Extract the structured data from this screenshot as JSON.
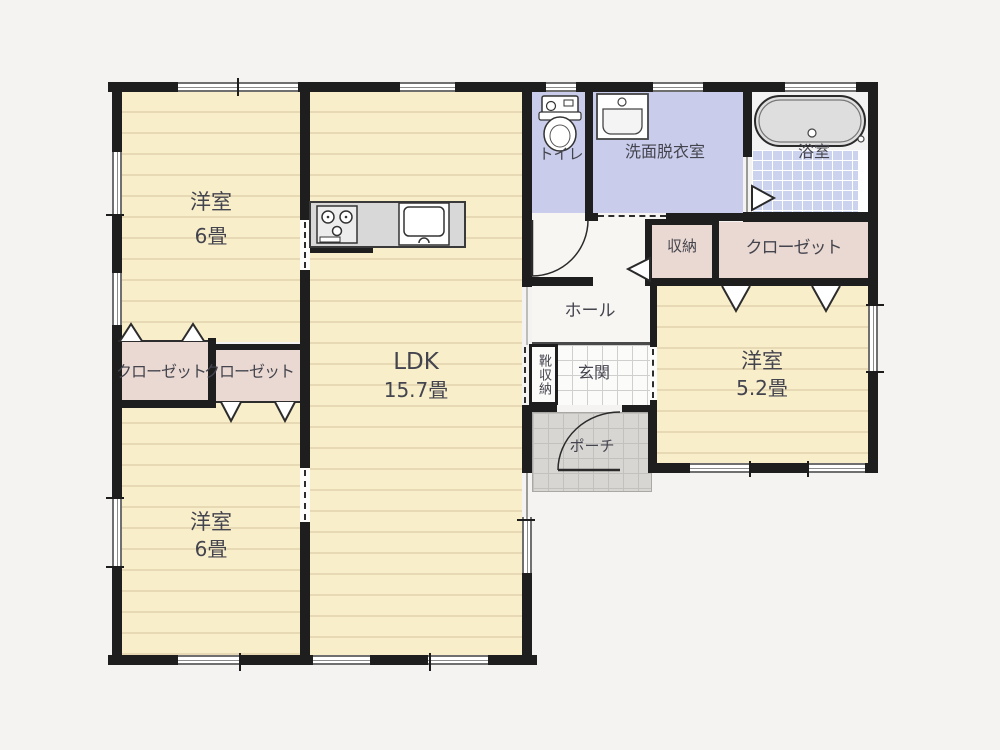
{
  "figure_type": "floor-plan",
  "colors": {
    "wall": "#1e1e1e",
    "room_floor": "#f8eeca",
    "floor_line": "#e7d9b4",
    "closet": "#ead9d2",
    "wet_room": "#c9cdeb",
    "bath_tile": "#ccd3ee",
    "porch_tile": "#d7d6d3",
    "hall": "#f7f6f3",
    "text": "#44444e"
  },
  "rooms": {
    "bedroom_nw": {
      "name": "洋室",
      "area": "6畳"
    },
    "bedroom_sw": {
      "name": "洋室",
      "area": "6畳"
    },
    "bedroom_e": {
      "name": "洋室",
      "area": "5.2畳"
    },
    "ldk": {
      "name": "LDK",
      "area": "15.7畳"
    },
    "toilet": {
      "name": "トイレ"
    },
    "washroom": {
      "name": "洗面脱衣室"
    },
    "bathroom": {
      "name": "浴室"
    },
    "hall": {
      "name": "ホール"
    },
    "entrance": {
      "name": "玄関"
    },
    "porch": {
      "name": "ポーチ"
    },
    "storage": {
      "name": "収納"
    },
    "closet_east": {
      "name": "クローゼット"
    },
    "closet_west_left": {
      "name": "クローゼット"
    },
    "closet_west_right": {
      "name": "クローゼット"
    },
    "shoe_storage": {
      "name": "靴収納"
    }
  }
}
